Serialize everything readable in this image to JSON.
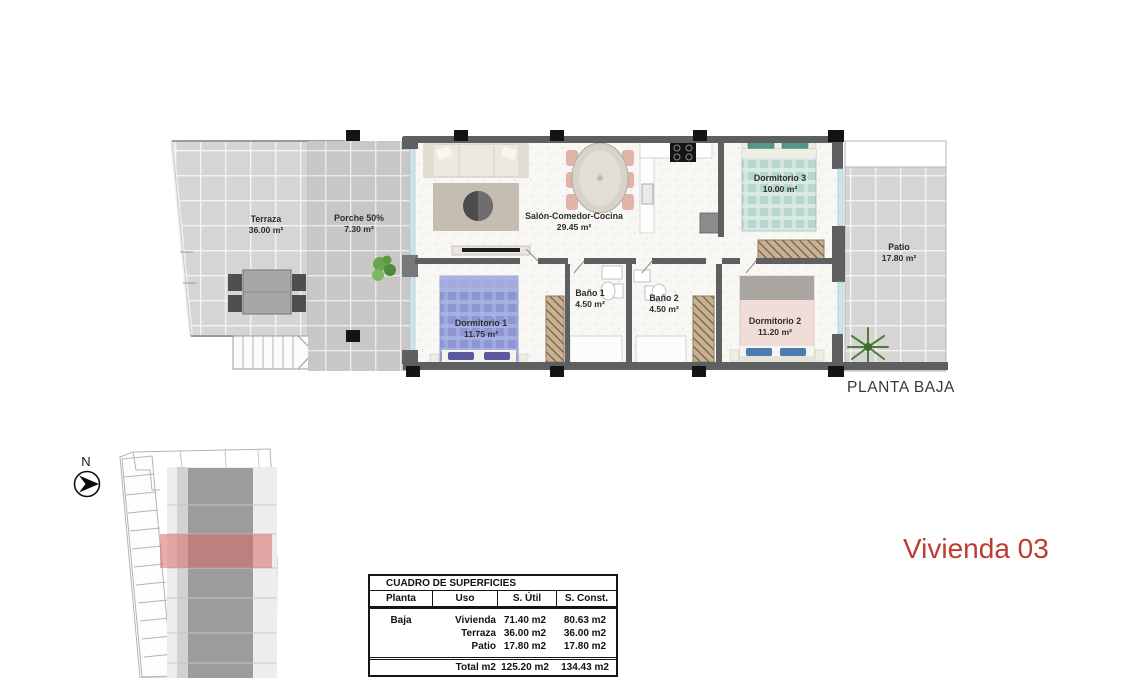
{
  "floor_plan": {
    "title": "PLANTA BAJA",
    "rooms": [
      {
        "name": "Terraza",
        "area": "36.00 m²"
      },
      {
        "name": "Porche 50%",
        "area": "7.30 m²"
      },
      {
        "name": "Salón-Comedor-Cocina",
        "area": "29.45 m²"
      },
      {
        "name": "Dormitorio 3",
        "area": "10.00 m²"
      },
      {
        "name": "Patio",
        "area": "17.80 m²"
      },
      {
        "name": "Dormitorio 1",
        "area": "11.75 m²"
      },
      {
        "name": "Baño 1",
        "area": "4.50 m²"
      },
      {
        "name": "Baño 2",
        "area": "4.50 m²"
      },
      {
        "name": "Dormitorio 2",
        "area": "11.20 m²"
      }
    ]
  },
  "compass": {
    "label": "N"
  },
  "unit_title": {
    "text": "Vivienda 03"
  },
  "surfaces_table": {
    "title": "CUADRO DE SUPERFICIES",
    "headers": [
      "Planta",
      "Uso",
      "S. Útil",
      "S. Const."
    ],
    "rows": [
      {
        "planta": "Baja",
        "uso": "Vivienda",
        "util": "71.40 m2",
        "const": "80.63 m2"
      },
      {
        "planta": "",
        "uso": "Terraza",
        "util": "36.00 m2",
        "const": "36.00 m2"
      },
      {
        "planta": "",
        "uso": "Patio",
        "util": "17.80 m2",
        "const": "17.80 m2"
      }
    ],
    "total": {
      "label": "Total m2",
      "util": "125.20 m2",
      "const": "134.43 m2"
    }
  },
  "colors": {
    "unit_title_red": "#bf3b2f",
    "site_highlight_red": "#d96a6a",
    "wall_gray": "#5e5f60",
    "terrace_tile": "#d6d5d3",
    "porch_tile": "#c8c7c5",
    "bed1_purple": "#8e95d3",
    "bed2_pink": "#f1ddd8",
    "bed3_teal": "#b7d6cd"
  }
}
